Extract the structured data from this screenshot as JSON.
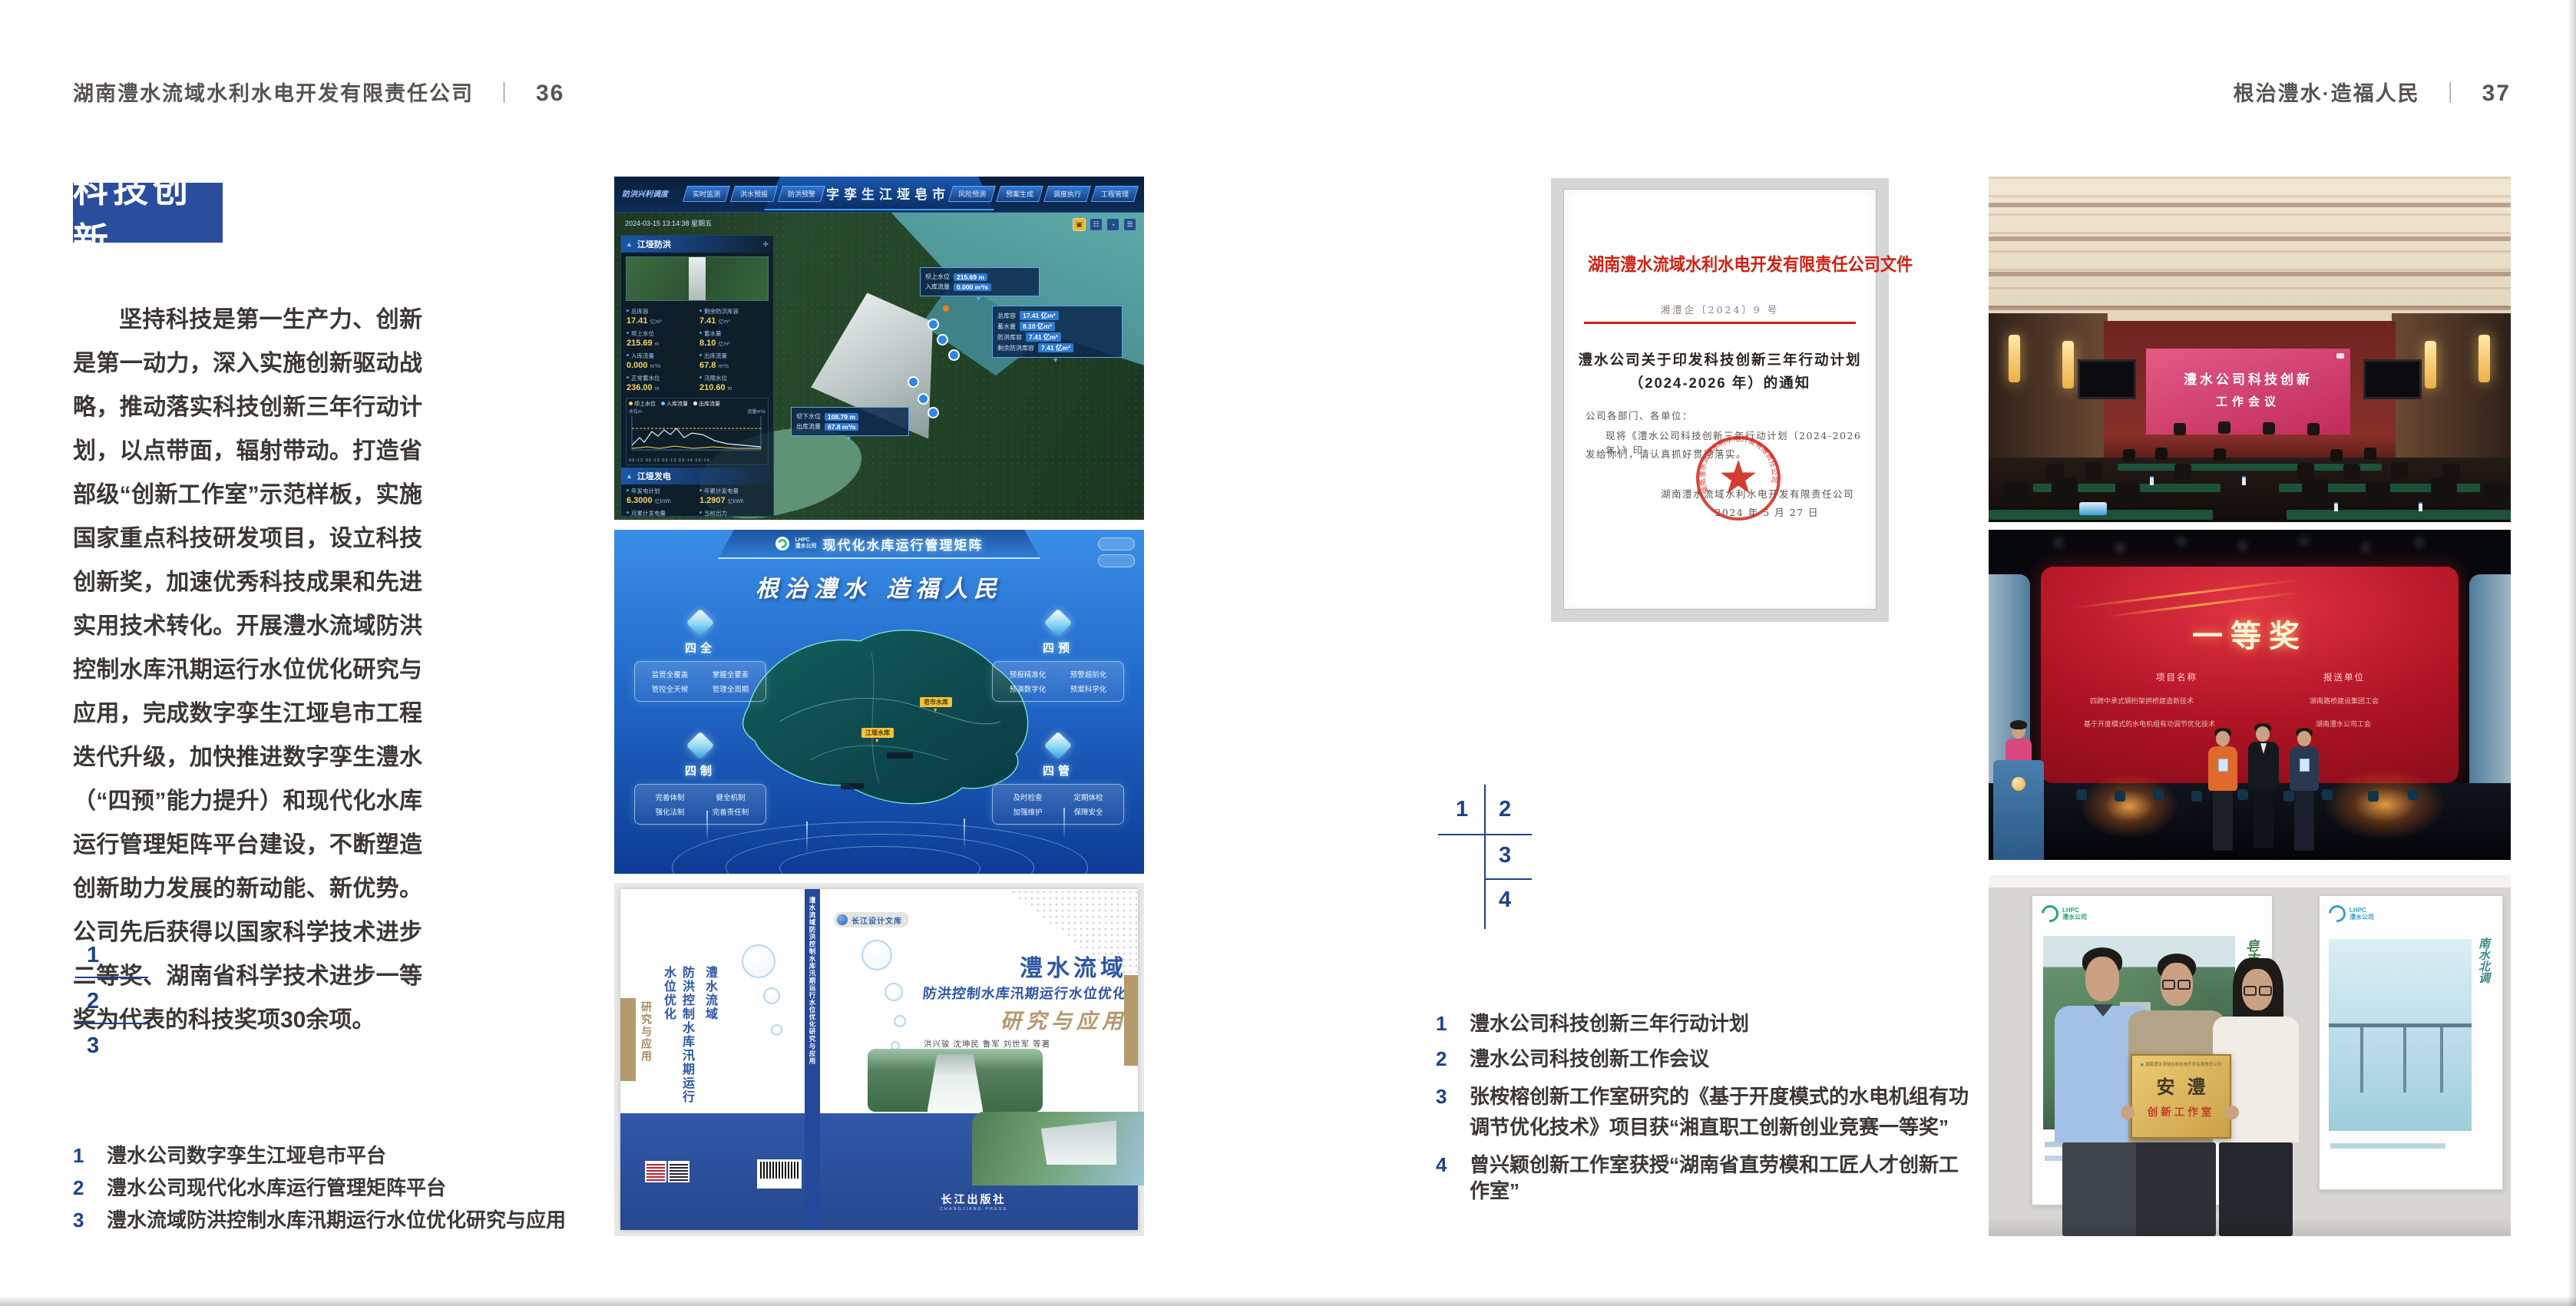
{
  "page_left": {
    "header": {
      "company": "湖南澧水流域水利水电开发有限责任公司",
      "separator": "｜",
      "page_number": "36"
    },
    "badge": "科技创新",
    "paragraph": "坚持科技是第一生产力、创新是第一动力，深入实施创新驱动战略，推动落实科技创新三年行动计划，以点带面，辐射带动。打造省部级“创新工作室”示范样板，实施国家重点科技研发项目，设立科技创新奖，加速优秀科技成果和先进实用技术转化。开展澧水流域防洪控制水库汛期运行水位优化研究与应用，完成数字孪生江垭皂市工程迭代升级，加快推进数字孪生澧水（“四预”能力提升）和现代化水库运行管理矩阵平台建设，不断塑造创新助力发展的新动能、新优势。公司先后获得以国家科学技术进步二等奖、湖南省科学技术进步一等奖为代表的科技奖项30余项。",
    "figure_index": {
      "n1": "1",
      "n2": "2",
      "n3": "3"
    },
    "captions": [
      {
        "num": "1",
        "text": "澧水公司数字孪生江垭皂市平台"
      },
      {
        "num": "2",
        "text": "澧水公司现代化水库运行管理矩阵平台"
      },
      {
        "num": "3",
        "text": "澧水流域防洪控制水库汛期运行水位优化研究与应用"
      }
    ],
    "dashboard": {
      "title": "数字孪生江垭皂市",
      "group_label": "防洪兴利调度",
      "tabs_left": [
        "实时监测",
        "洪水预报",
        "防洪预警"
      ],
      "tabs_right": [
        "风险预测",
        "预案生成",
        "调度执行",
        "工程管理"
      ],
      "datetime": "2024-03-15 13:14:38 星期五",
      "panel1": {
        "title": "江垭防洪",
        "stats": [
          {
            "l": "总库容",
            "v": "17.41",
            "u": "亿m³"
          },
          {
            "l": "剩余防洪库容",
            "v": "7.41",
            "u": "亿m³"
          },
          {
            "l": "坝上水位",
            "v": "215.69",
            "u": "m"
          },
          {
            "l": "蓄水量",
            "v": "8.10",
            "u": "亿m³"
          },
          {
            "l": "入库流量",
            "v": "0.000",
            "u": "m³/s"
          },
          {
            "l": "出库流量",
            "v": "67.8",
            "u": "m³/s"
          },
          {
            "l": "正常蓄水位",
            "v": "236.00",
            "u": "m"
          },
          {
            "l": "汛限水位",
            "v": "210.60",
            "u": "m"
          }
        ]
      },
      "chart": {
        "unit_left": "水位m",
        "unit_right": "流量m³/s",
        "legend": [
          "坝上水位",
          "入库流量",
          "出库流量"
        ],
        "xlabels": "03-12   03-13   03-13   03-14   03-14"
      },
      "panel2": {
        "title": "江垭发电",
        "stats": [
          {
            "l": "年发电计划",
            "v": "6.3000",
            "u": "亿kWh"
          },
          {
            "l": "年累计发电量",
            "v": "1.2907",
            "u": "亿kWh"
          },
          {
            "l": "月累计发电量",
            "v": "3359.21",
            "u": "万"
          },
          {
            "l": "当前出力",
            "v": "0.00",
            "u": "MW"
          },
          {
            "l": "发电流量",
            "v": "0.00",
            "u": "m³/s"
          },
          {
            "l": "弃水流量",
            "v": "0.00",
            "u": "m³/s"
          }
        ]
      },
      "callout1": [
        {
          "l": "坝上水位",
          "v": "215.69 m"
        },
        {
          "l": "入库流量",
          "v": "0.000 m³/s"
        }
      ],
      "callout2": [
        {
          "l": "总库容",
          "v": "17.41 亿m³"
        },
        {
          "l": "蓄水量",
          "v": "8.10 亿m³"
        },
        {
          "l": "防洪库容",
          "v": "7.41 亿m³"
        },
        {
          "l": "剩余防洪库容",
          "v": "7.41 亿m³"
        }
      ],
      "callout3": [
        {
          "l": "坝下水位",
          "v": "108.79 m"
        },
        {
          "l": "出库流量",
          "v": "67.8 m³/s"
        }
      ]
    },
    "matrix": {
      "logo_line1": "LHPC",
      "logo_line2": "澧水公司",
      "title": "现代化水库运行管理矩阵",
      "slogan": "根治澧水 造福人民",
      "panels": [
        {
          "title": "四全",
          "items": [
            "监管全覆盖",
            "掌握全要素",
            "管控全天候",
            "管理全周期"
          ]
        },
        {
          "title": "四预",
          "items": [
            "预报精准化",
            "预警超前化",
            "预演数字化",
            "预案科学化"
          ]
        },
        {
          "title": "四制",
          "items": [
            "完善体制",
            "健全机制",
            "强化法制",
            "完善责任制"
          ]
        },
        {
          "title": "四管",
          "items": [
            "及时检查",
            "定期体检",
            "加强维护",
            "保障安全"
          ]
        }
      ],
      "map_labels": [
        "皂市水库",
        "江垭水库"
      ]
    },
    "book": {
      "series": "长江设计文库",
      "title_region": "澧水流域",
      "title_sub": "防洪控制水库汛期运行水位优化",
      "title_tail": "研究与应用",
      "authors": "洪兴骏  沈坤民  鲁军  刘世军  等著",
      "publisher": "长江出版社",
      "publisher_en": "CHANGJIANG PRESS",
      "spine_text": "澧水流域防洪控制水库汛期运行水位优化研究与应用",
      "back_title_1": "澧水流域",
      "back_title_2": "防洪控制水库汛期运行水位优化",
      "back_title_3": "研究与应用"
    }
  },
  "page_right": {
    "header": {
      "slogan": "根治澧水·造福人民",
      "separator": "｜",
      "page_number": "37"
    },
    "document": {
      "masthead": "湖南澧水流域水利水电开发有限责任公司文件",
      "doc_no": "湘澧企〔2024〕9 号",
      "title_line1": "澧水公司关于印发科技创新三年行动计划",
      "title_line2": "（2024-2026 年）的通知",
      "salutation": "公司各部门、各单位：",
      "body_line1": "现将《澧水公司科技创新三年行动计划（2024-2026 年）》印",
      "body_line2": "发给你们，请认真抓好贯彻落实。",
      "signer": "湖南澧水流域水利水电开发有限责任公司",
      "date": "2024 年 5 月 27 日",
      "seal_text": "湖南澧水流域水利水电开发有限责任公司"
    },
    "figure_index": {
      "n1": "1",
      "n2": "2",
      "n3": "3",
      "n4": "4"
    },
    "captions": [
      {
        "num": "1",
        "text": "澧水公司科技创新三年行动计划"
      },
      {
        "num": "2",
        "text": "澧水公司科技创新工作会议"
      },
      {
        "num": "3",
        "text": "张桉榕创新工作室研究的《基于开度模式的水电机组有功调节优化技术》项目获“湘直职工创新创业竞赛一等奖”"
      },
      {
        "num": "4",
        "text": "曾兴颖创新工作室获授“湖南省直劳模和工匠人才创新工作室”"
      }
    ],
    "meeting": {
      "screen_line1": "澧水公司科技创新",
      "screen_line2": "工作会议"
    },
    "award": {
      "title": "一等奖",
      "col_project": "项目名称",
      "col_unit": "报送单位",
      "projects": [
        "四跨中承式钢桁架拱桥建造新技术",
        "基于开度模式的水电机组有功调节优化技术"
      ],
      "units": [
        "湖南路桥建设集团工会",
        "湖南澧水公司工会"
      ]
    },
    "plaque": {
      "org": "湖南澧水流域水利水电开发有限责任公司",
      "big": "安澧",
      "sub": "创新工作室",
      "poster_left_caption": "皂市水库",
      "poster_right_caption": "南水北调",
      "poster_logo_1": "LHPC",
      "poster_logo_2": "澧水公司"
    }
  }
}
